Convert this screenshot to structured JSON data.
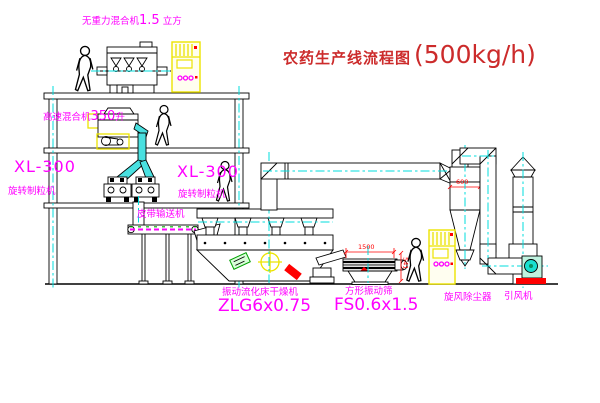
{
  "title": {
    "text": "农药生产线流程图",
    "capacity": "(500kg/h)"
  },
  "labels": {
    "gravity_mixer": {
      "name": "无重力混合机",
      "spec": "1.5",
      "unit": "立方"
    },
    "high_speed_mixer": {
      "name": "高速混合机",
      "spec": "350",
      "unit": "升"
    },
    "granulator_left": {
      "model": "XL-300",
      "name": "旋转制粒机"
    },
    "granulator_right": {
      "model": "XL-300",
      "name": "旋转制粒机"
    },
    "belt_conveyor": {
      "name": "皮带输送机"
    },
    "dryer": {
      "name": "振动流化床干燥机",
      "model": "ZLG6x0.75"
    },
    "sieve": {
      "name": "方形振动筛",
      "model": "FS0.6x1.5"
    },
    "cyclone": {
      "name": "旋风除尘器"
    },
    "draft_fan": {
      "name": "引风机"
    }
  },
  "dimensions": {
    "sieve_width": "1500",
    "sieve_height": "541",
    "cyclone_outlet": "600"
  },
  "colors": {
    "label_magenta": "#ff00ff",
    "title_red": "#cc2b2b",
    "centerline_cyan": "#00dcdc",
    "dimension_red": "#ff0000",
    "cabinet_yellow": "#ece300",
    "line_black": "#000000"
  }
}
